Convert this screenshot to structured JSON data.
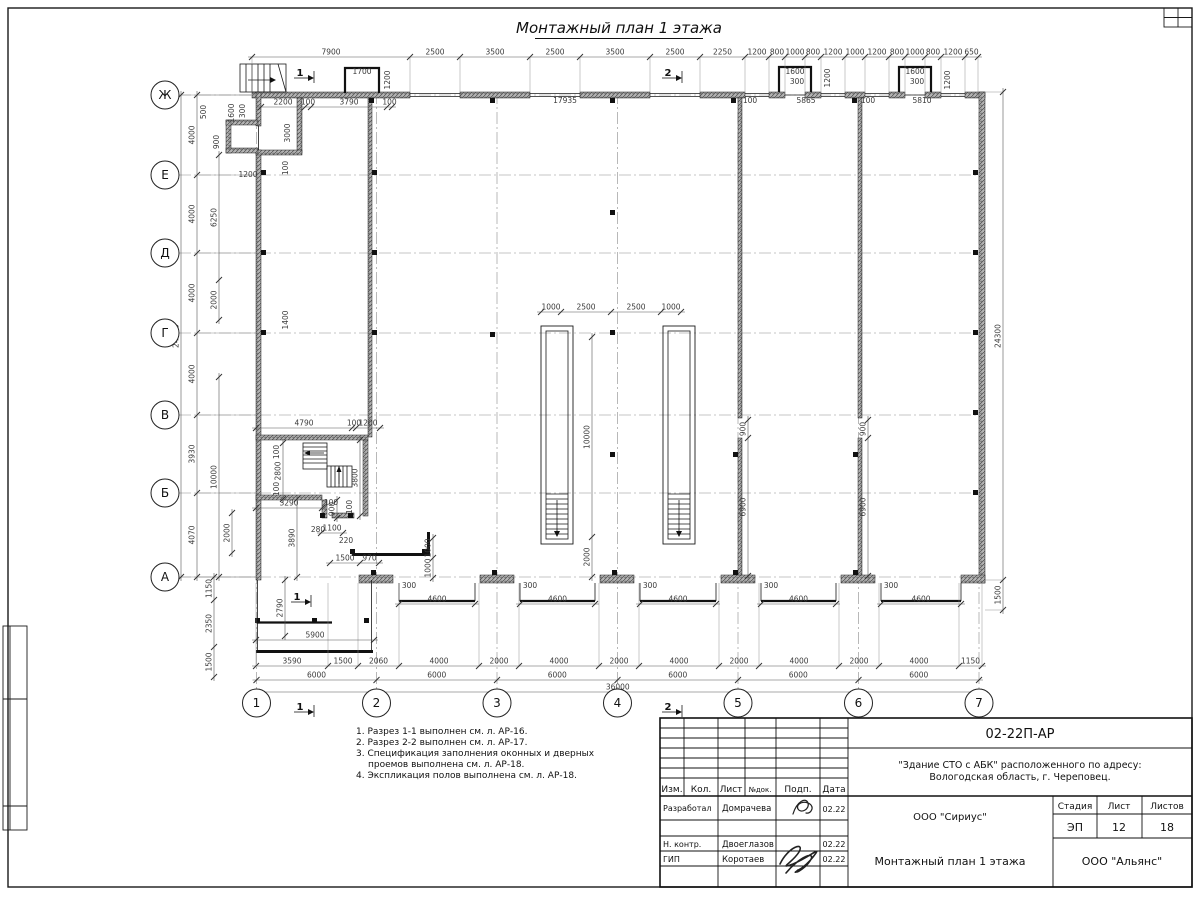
{
  "sheet": {
    "page_title": "Монтажный план 1 этажа",
    "code": "02-22П-АР",
    "object_line1": "\"Здание СТО с АБК\" расположенного по адресу:",
    "object_line2": "Вологодская область, г. Череповец.",
    "org": "ООО \"Сириус\"",
    "org2": "ООО \"Альянс\"",
    "drawing_name": "Монтажный план 1 этажа",
    "stage_label": "Стадия",
    "sheet_label": "Лист",
    "sheets_label": "Листов",
    "stage": "ЭП",
    "sheet_no": "12",
    "sheets_total": "18",
    "cols": {
      "izm": "Изм.",
      "kol": "Кол.",
      "list": "Лист",
      "ndok": "№док.",
      "podp": "Подп.",
      "data": "Дата"
    },
    "rows": [
      {
        "role": "Разработал",
        "name": "Домрачева",
        "date": "02.22"
      },
      {
        "role": "Н. контр.",
        "name": "Двоеглазов",
        "date": "02.22"
      },
      {
        "role": "ГИП",
        "name": "Коротаев",
        "date": "02.22"
      }
    ]
  },
  "notes": [
    {
      "t": "1. Разрез 1-1 выполнен см. л. АР-16.",
      "i": 0
    },
    {
      "t": "2. Разрез 2-2 выполнен см. л. АР-17.",
      "i": 0
    },
    {
      "t": "3. Спецификация заполнения оконных и дверных",
      "i": 0
    },
    {
      "t": "проемов выполнена см. л. АР-18.",
      "i": 1
    },
    {
      "t": "4. Экспликация полов выполнена см. л. АР-18.",
      "i": 0
    }
  ],
  "axes": {
    "cols": [
      {
        "n": "1",
        "x": 256.5
      },
      {
        "n": "2",
        "x": 376.5
      },
      {
        "n": "3",
        "x": 497
      },
      {
        "n": "4",
        "x": 617.5
      },
      {
        "n": "5",
        "x": 738
      },
      {
        "n": "6",
        "x": 858.5
      },
      {
        "n": "7",
        "x": 979
      }
    ],
    "rows": [
      {
        "n": "Ж",
        "y": 95
      },
      {
        "n": "Е",
        "y": 175
      },
      {
        "n": "Д",
        "y": 253
      },
      {
        "n": "Г",
        "y": 333
      },
      {
        "n": "В",
        "y": 415
      },
      {
        "n": "Б",
        "y": 493
      },
      {
        "n": "А",
        "y": 577
      }
    ]
  },
  "plan": {
    "chains": [
      {
        "d": "h",
        "p": 57,
        "e": 92,
        "t": [
          252,
          410,
          460,
          530,
          580,
          650,
          700,
          745,
          769,
          785,
          805,
          821,
          845,
          865,
          889,
          905,
          925,
          941,
          965,
          978
        ],
        "l": [
          "7900",
          "2500",
          "3500",
          "2500",
          "3500",
          "2500",
          "2250",
          "1200",
          "800",
          "1000",
          "800",
          "1200",
          "1000",
          "1200",
          "800",
          "1000",
          "800",
          "1200",
          "650"
        ]
      },
      {
        "d": "h",
        "p": 666,
        "e": 583,
        "t": [
          256,
          328,
          358,
          399,
          479,
          519,
          599,
          639,
          719,
          759,
          839,
          879,
          959,
          982
        ],
        "l": [
          "3590",
          "1500",
          "2060",
          "4000",
          "2000",
          "4000",
          "2000",
          "4000",
          "2000",
          "4000",
          "2000",
          "4000",
          "1150"
        ]
      },
      {
        "d": "h",
        "p": 680,
        "t": [
          256.5,
          376.5,
          497,
          617.5,
          738,
          858.5,
          979
        ],
        "l": [
          "6000",
          "6000",
          "6000",
          "6000",
          "6000",
          "6000"
        ]
      },
      {
        "d": "h",
        "p": 692,
        "t": [
          256.5,
          979
        ],
        "l": [
          "36000"
        ]
      },
      {
        "d": "v",
        "p": 181,
        "e": 256,
        "t": [
          95,
          577
        ],
        "l": [
          "24000"
        ]
      },
      {
        "d": "v",
        "p": 197,
        "e": 256,
        "t": [
          95,
          175,
          253,
          333,
          415,
          493,
          577
        ],
        "l": [
          "4000",
          "4000",
          "4000",
          "4000",
          "3930",
          "4070"
        ]
      },
      {
        "d": "v",
        "p": 214,
        "t": [
          577,
          600,
          647,
          677
        ],
        "l": [
          "1150",
          "2350",
          "1500"
        ]
      },
      {
        "d": "v",
        "p": 219,
        "t": [
          155,
          280,
          320
        ],
        "l": [
          "6250",
          "2000"
        ]
      },
      {
        "d": "v",
        "p": 219,
        "t": [
          377,
          577
        ],
        "l": [
          "10000"
        ]
      },
      {
        "d": "v",
        "p": 232,
        "t": [
          513,
          553
        ],
        "l": [
          "2000"
        ]
      },
      {
        "d": "v",
        "p": 1003,
        "e": 985,
        "t": [
          92,
          580,
          610
        ],
        "l": [
          "24300",
          "1500"
        ]
      },
      {
        "d": "h",
        "p": 107,
        "t": [
          261,
          305,
          311,
          387,
          392
        ],
        "l": [
          "2200",
          "100",
          "3790",
          "100"
        ]
      },
      {
        "d": "h",
        "p": 312,
        "t": [
          541,
          561,
          611,
          661,
          681
        ],
        "l": [
          "1000",
          "2500",
          "2500",
          "1000"
        ]
      },
      {
        "d": "v",
        "p": 592,
        "t": [
          337,
          537,
          577
        ],
        "l": [
          "10000",
          "2000"
        ]
      },
      {
        "d": "v",
        "p": 748,
        "t": [
          420,
          438,
          576
        ],
        "l": [
          "900",
          "6900"
        ]
      },
      {
        "d": "v",
        "p": 868,
        "t": [
          420,
          438,
          576
        ],
        "l": [
          "900",
          "6900"
        ]
      },
      {
        "d": "h",
        "p": 428,
        "t": [
          256,
          352,
          356,
          380
        ],
        "l": [
          "4790",
          "100",
          "1200"
        ]
      },
      {
        "d": "v",
        "p": 283,
        "t": [
          443,
          499
        ],
        "l": [
          "2800"
        ]
      },
      {
        "d": "v",
        "p": 360,
        "t": [
          440,
          516
        ],
        "l": [
          "3800"
        ]
      },
      {
        "d": "h",
        "p": 508,
        "t": [
          256,
          322
        ],
        "l": [
          "3290"
        ]
      },
      {
        "d": "v",
        "p": 337,
        "t": [
          500,
          518
        ],
        "l": [
          "900"
        ]
      },
      {
        "d": "v",
        "p": 297,
        "t": [
          499,
          577
        ],
        "l": [
          "3890"
        ]
      },
      {
        "d": "v",
        "p": 285,
        "t": [
          580,
          636
        ],
        "l": [
          "2790"
        ]
      },
      {
        "d": "h",
        "p": 640,
        "t": [
          256,
          374
        ],
        "l": [
          "5900"
        ]
      },
      {
        "d": "h",
        "p": 563,
        "t": [
          330,
          360,
          379
        ],
        "l": [
          "1500",
          "970"
        ]
      },
      {
        "d": "h",
        "p": 533,
        "t": [
          321,
          343
        ],
        "l": [
          "1100"
        ]
      },
      {
        "d": "v",
        "p": 433,
        "t": [
          538,
          558,
          578
        ],
        "l": [
          "1000",
          "1000"
        ]
      },
      {
        "d": "h",
        "p": 604,
        "t": [
          399,
          475
        ],
        "l": [
          "4600"
        ]
      },
      {
        "d": "h",
        "p": 604,
        "t": [
          520,
          595
        ],
        "l": [
          "4600"
        ]
      },
      {
        "d": "h",
        "p": 604,
        "t": [
          640,
          716
        ],
        "l": [
          "4600"
        ]
      },
      {
        "d": "h",
        "p": 604,
        "t": [
          761,
          836
        ],
        "l": [
          "4600"
        ]
      },
      {
        "d": "h",
        "p": 604,
        "t": [
          881,
          961
        ],
        "l": [
          "4600"
        ]
      }
    ],
    "labels": [
      {
        "x": 565,
        "y": 103,
        "t": "17935"
      },
      {
        "x": 750,
        "y": 103,
        "t": "100"
      },
      {
        "x": 806,
        "y": 103,
        "t": "5865"
      },
      {
        "x": 868,
        "y": 103,
        "t": "100"
      },
      {
        "x": 922,
        "y": 103,
        "t": "5810"
      },
      {
        "x": 206,
        "y": 112,
        "t": "500",
        "r": 1
      },
      {
        "x": 219,
        "y": 142,
        "t": "900",
        "r": 1
      },
      {
        "x": 234,
        "y": 113,
        "t": "1600",
        "r": 1
      },
      {
        "x": 245,
        "y": 111,
        "t": "300",
        "r": 1
      },
      {
        "x": 248,
        "y": 177,
        "t": "1200"
      },
      {
        "x": 290,
        "y": 133,
        "t": "3000",
        "r": 1
      },
      {
        "x": 288,
        "y": 168,
        "t": "100",
        "r": 1
      },
      {
        "x": 288,
        "y": 320,
        "t": "1400",
        "r": 1
      },
      {
        "x": 362,
        "y": 74,
        "t": "1700"
      },
      {
        "x": 390,
        "y": 80,
        "t": "1200",
        "r": 1
      },
      {
        "x": 795,
        "y": 74,
        "t": "1600"
      },
      {
        "x": 797,
        "y": 84,
        "t": "300"
      },
      {
        "x": 830,
        "y": 78,
        "t": "1200",
        "r": 1
      },
      {
        "x": 915,
        "y": 74,
        "t": "1600"
      },
      {
        "x": 917,
        "y": 84,
        "t": "300"
      },
      {
        "x": 950,
        "y": 80,
        "t": "1200",
        "r": 1
      },
      {
        "x": 279,
        "y": 452,
        "t": "100",
        "r": 1
      },
      {
        "x": 279,
        "y": 489,
        "t": "100",
        "r": 1
      },
      {
        "x": 352,
        "y": 507,
        "t": "100",
        "r": 1
      },
      {
        "x": 331,
        "y": 505,
        "t": "100"
      },
      {
        "x": 318,
        "y": 532,
        "t": "280"
      },
      {
        "x": 346,
        "y": 543,
        "t": "220"
      },
      {
        "x": 409,
        "y": 588,
        "t": "300"
      },
      {
        "x": 530,
        "y": 588,
        "t": "300"
      },
      {
        "x": 650,
        "y": 588,
        "t": "300"
      },
      {
        "x": 771,
        "y": 588,
        "t": "300"
      },
      {
        "x": 891,
        "y": 588,
        "t": "300"
      }
    ],
    "sections": [
      {
        "x": 300,
        "y": 76,
        "t": "1"
      },
      {
        "x": 668,
        "y": 76,
        "t": "2"
      },
      {
        "x": 300,
        "y": 710,
        "t": "1"
      },
      {
        "x": 668,
        "y": 710,
        "t": "2"
      },
      {
        "x": 297,
        "y": 600,
        "t": "1"
      }
    ]
  }
}
